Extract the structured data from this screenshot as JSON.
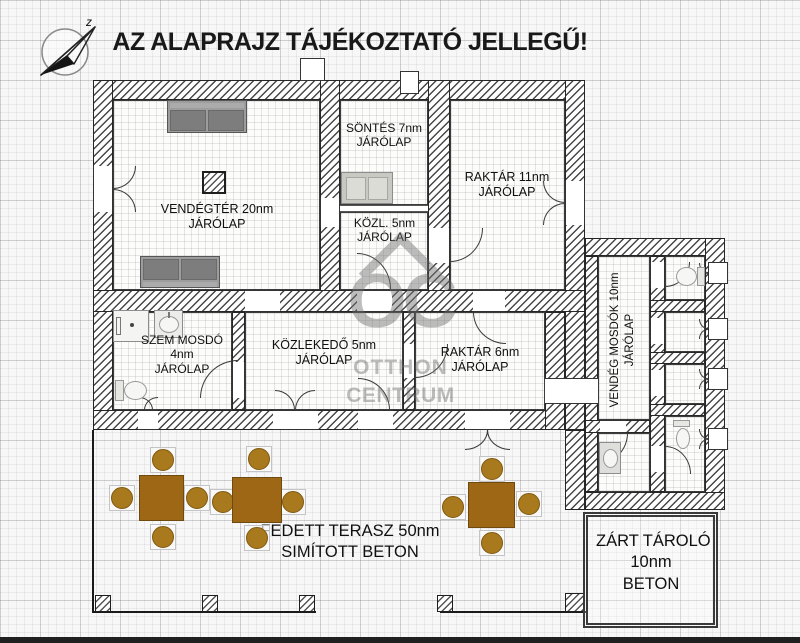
{
  "title": "AZ ALAPRAJZ TÁJÉKOZTATÓ JELLEGŰ!",
  "compass": {
    "letter": "z"
  },
  "rooms": {
    "vendegter": {
      "line1": "VENDÉGTÉR 20nm",
      "line2": "JÁRÓLAP"
    },
    "sontes": {
      "line1": "SÖNTÉS 7nm",
      "line2": "JÁRÓLAP"
    },
    "raktar11": {
      "line1": "RAKTÁR 11nm",
      "line2": "JÁRÓLAP"
    },
    "kozl": {
      "line1": "KÖZL. 5nm",
      "line2": "JÁRÓLAP"
    },
    "szem_mosdo": {
      "line1": "SZEM MOSDÓ",
      "line2": "4nm",
      "line3": "JÁRÓLAP"
    },
    "kozlekedo": {
      "line1": "KÖZLEKEDŐ 5nm",
      "line2": "JÁRÓLAP"
    },
    "raktar6": {
      "line1": "RAKTÁR 6nm",
      "line2": "JÁRÓLAP"
    },
    "vendeg_mosdok": {
      "line1": "VENDÉG MOSDÓK 10nm",
      "line2": "JÁRÓLAP"
    },
    "terasz": {
      "line1": "FEDETT TERASZ 50nm",
      "line2": "SIMÍTOTT BETON"
    },
    "zart_tarolo": {
      "line1": "ZÁRT TÁROLÓ",
      "line2": "10nm",
      "line3": "BETON"
    }
  },
  "watermark": {
    "logo": "OC",
    "line1": "OTTHON",
    "line2": "CENTRUM"
  },
  "colors": {
    "table_brown": "#9e6716",
    "chair_brown": "#a8791d",
    "sofa_gray": "#8a8a8a",
    "wall_hatch_dark": "#474747",
    "watermark_gray": "#6e6e6e"
  }
}
